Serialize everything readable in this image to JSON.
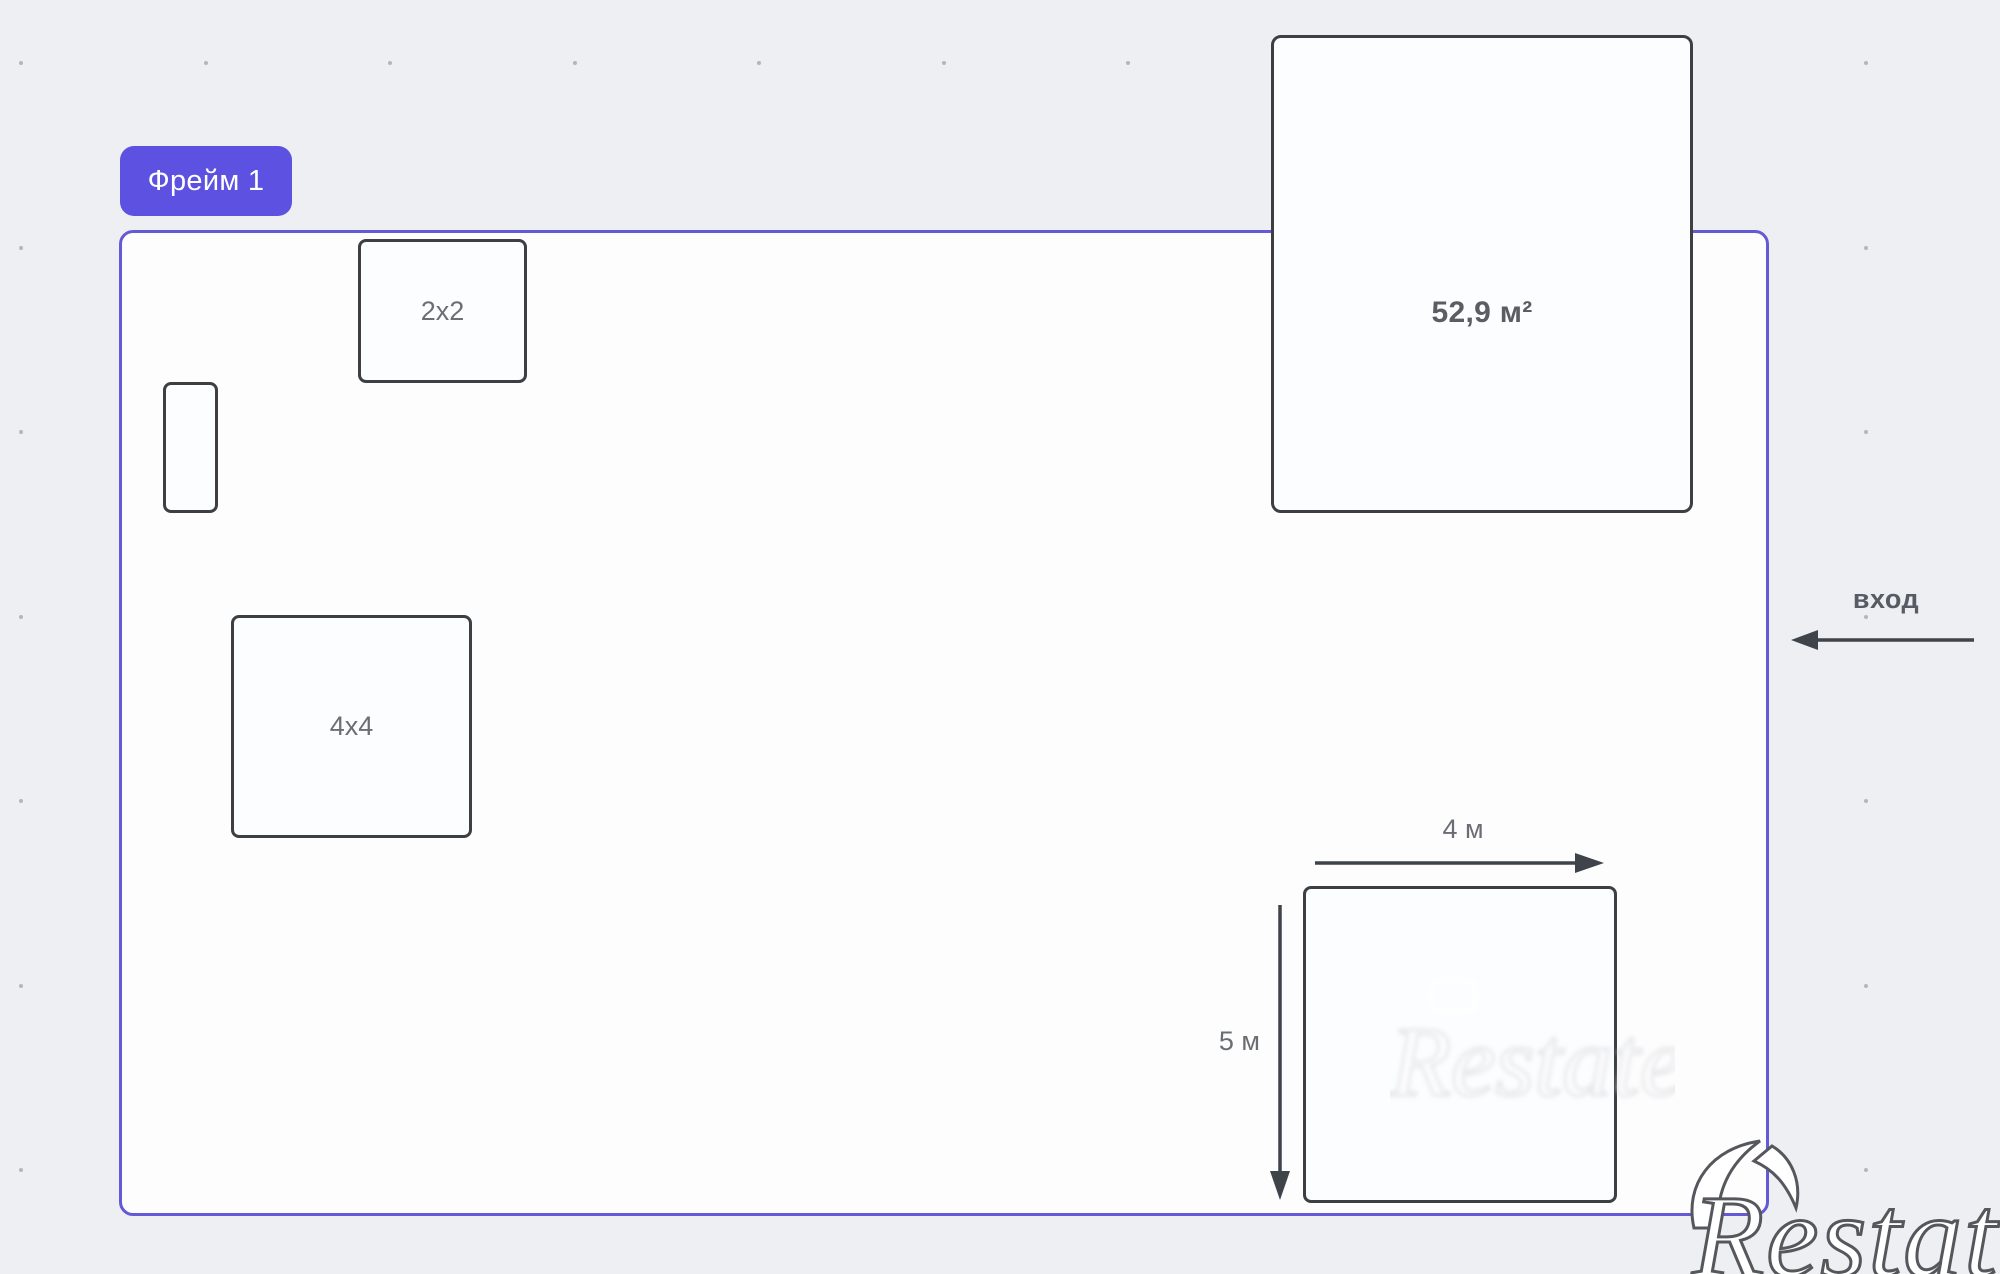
{
  "canvas": {
    "width": 2000,
    "height": 1274,
    "background": "#edeff2"
  },
  "grid": {
    "origin_x": 21,
    "origin_y": 63,
    "spacing": 184.5,
    "cols": 11,
    "rows": 7,
    "dot_color": "#b3b6bb"
  },
  "frame": {
    "label": "Фрейм 1",
    "accent_color": "#5c51e0",
    "border_color": "#6459d6"
  },
  "shapes": {
    "box_2x2": {
      "label": "2x2"
    },
    "box_4x4": {
      "label": "4x4"
    },
    "box_small": {
      "label": ""
    },
    "area_box": {
      "label": "52,9 м²"
    },
    "dim_box": {
      "width_label": "4 м",
      "height_label": "5 м"
    }
  },
  "entrance": {
    "label": "вход"
  },
  "watermark": {
    "brand": "Restate",
    "ghost": "Restate"
  },
  "colors": {
    "shape_border": "#3c4043",
    "arrow_color": "#3f444b",
    "shape_text": "#6b6f74",
    "dark_text": "#5a5e63"
  }
}
